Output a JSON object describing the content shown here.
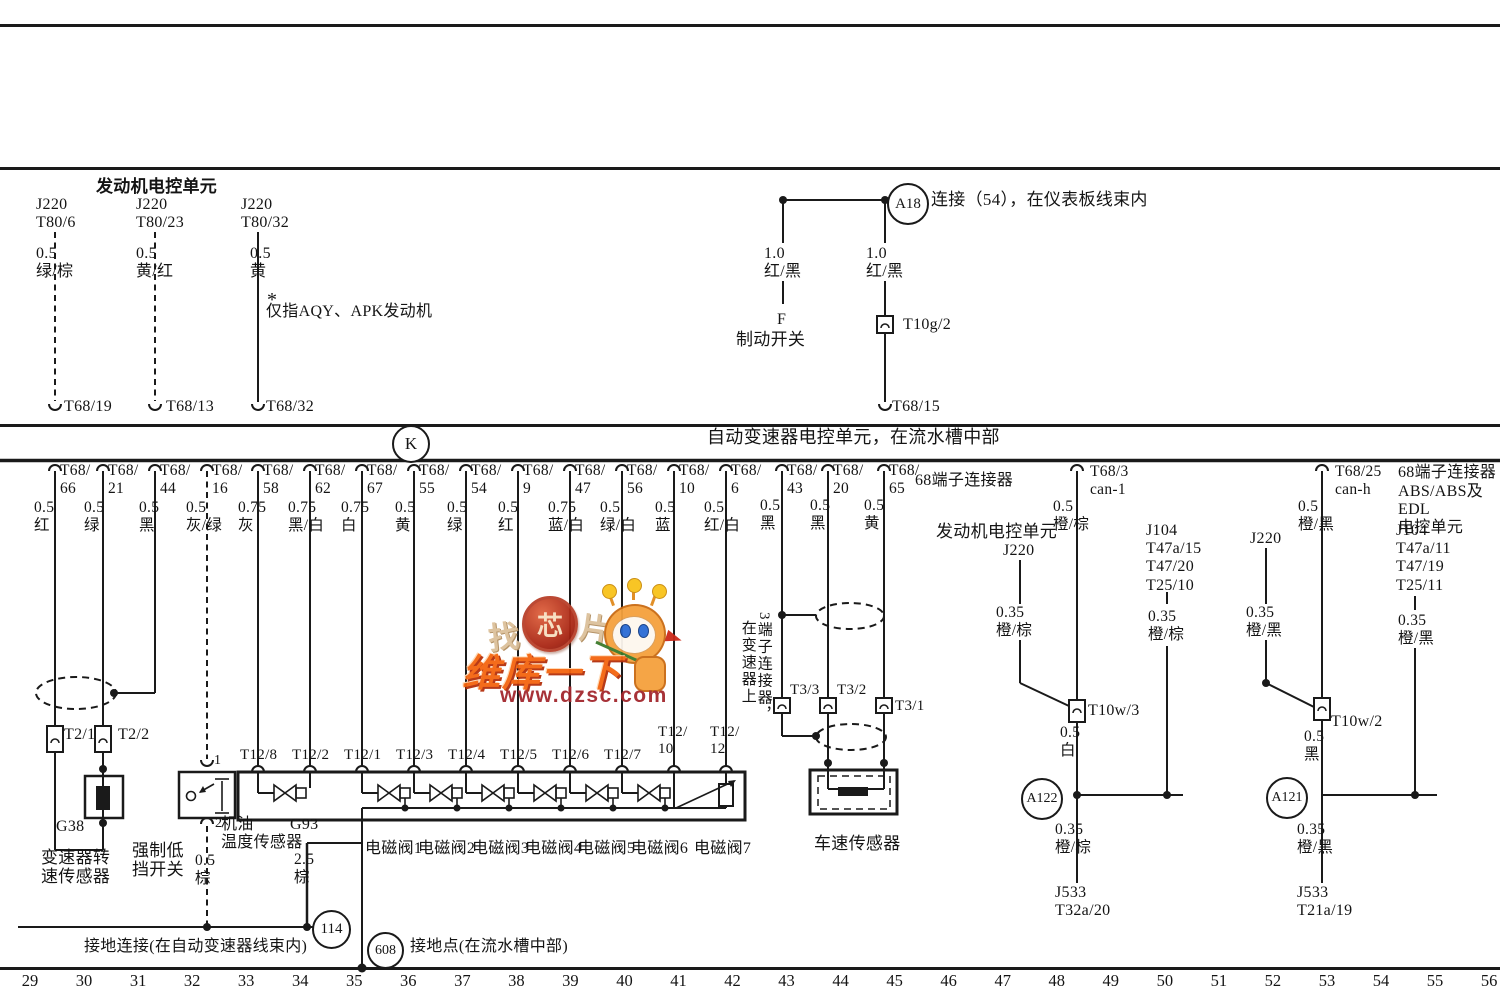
{
  "watermark": {
    "find_1": "找",
    "find_2": "芯",
    "find_3": "片",
    "brand": "维库一下",
    "url": "www.dzsc.com"
  },
  "labels": [
    {
      "n": "engine-ecu-title",
      "t": "发动机电控单元",
      "x": 96,
      "y": 177,
      "fs": 17,
      "b": 1
    },
    {
      "n": "pin-label",
      "t": "J220\nT80/6",
      "x": 36,
      "y": 196,
      "fs": 16
    },
    {
      "n": "pin-label",
      "t": "J220\nT80/23",
      "x": 136,
      "y": 196,
      "fs": 16
    },
    {
      "n": "pin-label",
      "t": "J220\nT80/32",
      "x": 241,
      "y": 196,
      "fs": 16
    },
    {
      "n": "wire-color-label",
      "t": "0.5\n绿/棕",
      "x": 36,
      "y": 245,
      "fs": 16
    },
    {
      "n": "wire-color-label",
      "t": "0.5\n黄/红",
      "x": 136,
      "y": 245,
      "fs": 16
    },
    {
      "n": "wire-color-label",
      "t": "0.5\n黄",
      "x": 250,
      "y": 245,
      "fs": 16
    },
    {
      "n": "footnote-star",
      "t": "*",
      "x": 267,
      "y": 289,
      "fs": 20
    },
    {
      "n": "engine-note",
      "t": "仅指AQY、APK发动机",
      "x": 266,
      "y": 303,
      "fs": 16
    },
    {
      "n": "terminal-label",
      "t": "T68/19",
      "x": 64,
      "y": 398,
      "fs": 16
    },
    {
      "n": "terminal-label",
      "t": "T68/13",
      "x": 166,
      "y": 398,
      "fs": 16
    },
    {
      "n": "terminal-label",
      "t": "T68/32",
      "x": 266,
      "y": 398,
      "fs": 16
    },
    {
      "n": "a18-desc",
      "t": "连接（54），在仪表板线束内",
      "x": 931,
      "y": 190,
      "fs": 17
    },
    {
      "n": "wire-color-label",
      "t": "1.0\n红/黑",
      "x": 764,
      "y": 245,
      "fs": 16
    },
    {
      "n": "brake-switch-id",
      "t": "F",
      "x": 777,
      "y": 311,
      "fs": 16
    },
    {
      "n": "brake-switch-label",
      "t": "制动开关",
      "x": 736,
      "y": 330,
      "fs": 17
    },
    {
      "n": "wire-color-label",
      "t": "1.0\n红/黑",
      "x": 866,
      "y": 245,
      "fs": 16
    },
    {
      "n": "connector-label",
      "t": "T10g/2",
      "x": 903,
      "y": 316,
      "fs": 16
    },
    {
      "n": "terminal-label",
      "t": "T68/15",
      "x": 892,
      "y": 398,
      "fs": 16
    },
    {
      "n": "band-title",
      "t": "自动变速器电控单元，在流水槽中部",
      "x": 707,
      "y": 427,
      "fs": 18
    },
    {
      "n": "pin-label",
      "t": "T68/\n66",
      "x": 60,
      "y": 462
    },
    {
      "n": "wire-color-label",
      "t": "0.5\n红",
      "x": 34,
      "y": 499
    },
    {
      "n": "pin-label",
      "t": "T68/\n21",
      "x": 108,
      "y": 462
    },
    {
      "n": "wire-color-label",
      "t": "0.5\n绿",
      "x": 84,
      "y": 499
    },
    {
      "n": "pin-label",
      "t": "T68/\n44",
      "x": 160,
      "y": 462
    },
    {
      "n": "wire-color-label",
      "t": "0.5\n黑",
      "x": 139,
      "y": 499
    },
    {
      "n": "pin-label",
      "t": "T68/\n16",
      "x": 212,
      "y": 462
    },
    {
      "n": "wire-color-label",
      "t": "0.5\n灰/绿",
      "x": 186,
      "y": 499
    },
    {
      "n": "pin-label",
      "t": "T68/\n58",
      "x": 263,
      "y": 462
    },
    {
      "n": "wire-color-label",
      "t": "0.75\n灰",
      "x": 238,
      "y": 499
    },
    {
      "n": "pin-label",
      "t": "T68/\n62",
      "x": 315,
      "y": 462
    },
    {
      "n": "wire-color-label",
      "t": "0.75\n黑/白",
      "x": 288,
      "y": 499
    },
    {
      "n": "pin-label",
      "t": "T68/\n67",
      "x": 367,
      "y": 462
    },
    {
      "n": "wire-color-label",
      "t": "0.75\n白",
      "x": 341,
      "y": 499
    },
    {
      "n": "pin-label",
      "t": "T68/\n55",
      "x": 419,
      "y": 462
    },
    {
      "n": "wire-color-label",
      "t": "0.5\n黄",
      "x": 395,
      "y": 499
    },
    {
      "n": "pin-label",
      "t": "T68/\n54",
      "x": 471,
      "y": 462
    },
    {
      "n": "wire-color-label",
      "t": "0.5\n绿",
      "x": 447,
      "y": 499
    },
    {
      "n": "pin-label",
      "t": "T68/\n9",
      "x": 523,
      "y": 462
    },
    {
      "n": "wire-color-label",
      "t": "0.5\n红",
      "x": 498,
      "y": 499
    },
    {
      "n": "pin-label",
      "t": "T68/\n47",
      "x": 575,
      "y": 462
    },
    {
      "n": "wire-color-label",
      "t": "0.75\n蓝/白",
      "x": 548,
      "y": 499
    },
    {
      "n": "pin-label",
      "t": "T68/\n56",
      "x": 627,
      "y": 462
    },
    {
      "n": "wire-color-label",
      "t": "0.5\n绿/白",
      "x": 600,
      "y": 499
    },
    {
      "n": "pin-label",
      "t": "T68/\n10",
      "x": 679,
      "y": 462
    },
    {
      "n": "wire-color-label",
      "t": "0.5\n蓝",
      "x": 655,
      "y": 499
    },
    {
      "n": "pin-label",
      "t": "T68/\n6",
      "x": 731,
      "y": 462
    },
    {
      "n": "wire-color-label",
      "t": "0.5\n红/白",
      "x": 704,
      "y": 499
    },
    {
      "n": "pin-label",
      "t": "T68/\n43",
      "x": 787,
      "y": 462
    },
    {
      "n": "wire-color-label",
      "t": "0.5\n黑",
      "x": 760,
      "y": 497
    },
    {
      "n": "pin-label",
      "t": "T68/\n20",
      "x": 833,
      "y": 462
    },
    {
      "n": "wire-color-label",
      "t": "0.5\n黑",
      "x": 810,
      "y": 497
    },
    {
      "n": "pin-label",
      "t": "T68/\n65",
      "x": 889,
      "y": 462
    },
    {
      "n": "wire-color-label",
      "t": "0.5\n黄",
      "x": 864,
      "y": 497
    },
    {
      "n": "connector-note",
      "t": "68端子连接器",
      "x": 915,
      "y": 472,
      "fs": 16
    },
    {
      "n": "pin-label",
      "t": "T68/3\ncan-1",
      "x": 1090,
      "y": 463
    },
    {
      "n": "wire-color-label",
      "t": "0.5\n橙/棕",
      "x": 1053,
      "y": 498
    },
    {
      "n": "pin-label",
      "t": "T68/25\ncan-h",
      "x": 1335,
      "y": 463
    },
    {
      "n": "wire-color-label",
      "t": "0.5\n橙/黑",
      "x": 1298,
      "y": 498
    },
    {
      "n": "connector-note",
      "t": "68端子连接器",
      "x": 1398,
      "y": 464,
      "fs": 16
    },
    {
      "n": "abs-ecu-label",
      "t": "ABS/ABS及EDL\n    电控单元",
      "x": 1398,
      "y": 483,
      "fs": 16
    },
    {
      "n": "engine-ecu-mid",
      "t": "发动机电控单元",
      "x": 936,
      "y": 522,
      "fs": 17
    },
    {
      "n": "pin-label",
      "t": "J220",
      "x": 1003,
      "y": 542,
      "fs": 16
    },
    {
      "n": "pin-label",
      "t": "J104\nT47a/15\nT47/20\nT25/10",
      "x": 1146,
      "y": 522,
      "fs": 16
    },
    {
      "n": "wire-color-label",
      "t": "0.35\n橙/棕",
      "x": 996,
      "y": 604
    },
    {
      "n": "wire-color-label",
      "t": "0.35\n橙/棕",
      "x": 1148,
      "y": 608
    },
    {
      "n": "pin-label",
      "t": "J220",
      "x": 1250,
      "y": 530,
      "fs": 16
    },
    {
      "n": "wire-color-label",
      "t": "0.35\n橙/黑",
      "x": 1246,
      "y": 604
    },
    {
      "n": "pin-label",
      "t": "J104\nT47a/11\nT47/19\nT25/11",
      "x": 1396,
      "y": 522,
      "fs": 16
    },
    {
      "n": "wire-color-label",
      "t": "0.35\n橙/黑",
      "x": 1398,
      "y": 612
    },
    {
      "n": "connector-label",
      "t": "T10w/3",
      "x": 1088,
      "y": 702,
      "fs": 16
    },
    {
      "n": "wire-color-label",
      "t": "0.5\n白",
      "x": 1060,
      "y": 724
    },
    {
      "n": "wire-color-label",
      "t": "0.35\n橙/棕",
      "x": 1055,
      "y": 821
    },
    {
      "n": "pin-label",
      "t": "J533\nT32a/20",
      "x": 1055,
      "y": 884,
      "fs": 16
    },
    {
      "n": "connector-label",
      "t": "T10w/2",
      "x": 1331,
      "y": 713,
      "fs": 16
    },
    {
      "n": "wire-color-label",
      "t": "0.5\n黑",
      "x": 1304,
      "y": 728
    },
    {
      "n": "wire-color-label",
      "t": "0.35\n橙/黑",
      "x": 1297,
      "y": 821
    },
    {
      "n": "pin-label",
      "t": "J533\nT21a/19",
      "x": 1297,
      "y": 884,
      "fs": 16
    },
    {
      "n": "connector-label",
      "t": "T2/1",
      "x": 64,
      "y": 726,
      "fs": 16
    },
    {
      "n": "connector-label",
      "t": "T2/2",
      "x": 118,
      "y": 726,
      "fs": 16
    },
    {
      "n": "component-id",
      "t": "G38",
      "x": 56,
      "y": 818,
      "fs": 16
    },
    {
      "n": "component-label",
      "t": "变速器转\n速传感器",
      "x": 41,
      "y": 848,
      "fs": 17
    },
    {
      "n": "component-label",
      "t": "强制低\n挡开关",
      "x": 132,
      "y": 841,
      "fs": 17
    },
    {
      "n": "pin-number",
      "t": "1",
      "x": 214,
      "y": 753,
      "fs": 14
    },
    {
      "n": "pin-number",
      "t": "2",
      "x": 215,
      "y": 816,
      "fs": 14
    },
    {
      "n": "wire-color-label",
      "t": "0.5\n棕",
      "x": 195,
      "y": 852
    },
    {
      "n": "component-label",
      "t": "机油\n温度传感器",
      "x": 221,
      "y": 816,
      "fs": 16
    },
    {
      "n": "component-id",
      "t": "G93",
      "x": 290,
      "y": 816,
      "fs": 16
    },
    {
      "n": "wire-color-label",
      "t": "2.5\n棕",
      "x": 294,
      "y": 851
    },
    {
      "n": "connector-label",
      "t": "T12/8",
      "x": 240,
      "y": 747,
      "fs": 15
    },
    {
      "n": "connector-label",
      "t": "T12/2",
      "x": 292,
      "y": 747,
      "fs": 15
    },
    {
      "n": "connector-label",
      "t": "T12/1",
      "x": 344,
      "y": 747,
      "fs": 15
    },
    {
      "n": "connector-label",
      "t": "T12/3",
      "x": 396,
      "y": 747,
      "fs": 15
    },
    {
      "n": "connector-label",
      "t": "T12/4",
      "x": 448,
      "y": 747,
      "fs": 15
    },
    {
      "n": "connector-label",
      "t": "T12/5",
      "x": 500,
      "y": 747,
      "fs": 15
    },
    {
      "n": "connector-label",
      "t": "T12/6",
      "x": 552,
      "y": 747,
      "fs": 15
    },
    {
      "n": "connector-label",
      "t": "T12/7",
      "x": 604,
      "y": 747,
      "fs": 15
    },
    {
      "n": "connector-label",
      "t": "T12/\n10",
      "x": 658,
      "y": 724,
      "fs": 15
    },
    {
      "n": "connector-label",
      "t": "T12/\n12",
      "x": 710,
      "y": 724,
      "fs": 15
    },
    {
      "n": "component-label",
      "t": "电磁阀1",
      "x": 365,
      "y": 840,
      "fs": 16
    },
    {
      "n": "component-label",
      "t": "电磁阀2",
      "x": 418,
      "y": 840,
      "fs": 16
    },
    {
      "n": "component-label",
      "t": "电磁阀3",
      "x": 472,
      "y": 840,
      "fs": 16
    },
    {
      "n": "component-label",
      "t": "电磁阀4",
      "x": 525,
      "y": 840,
      "fs": 16
    },
    {
      "n": "component-label",
      "t": "电磁阀5",
      "x": 578,
      "y": 840,
      "fs": 16
    },
    {
      "n": "component-label",
      "t": "电磁阀6",
      "x": 631,
      "y": 840,
      "fs": 16
    },
    {
      "n": "component-label",
      "t": "电磁阀7",
      "x": 694,
      "y": 840,
      "fs": 16
    },
    {
      "n": "connector-label",
      "t": "T3/3",
      "x": 790,
      "y": 682,
      "fs": 15
    },
    {
      "n": "connector-label",
      "t": "T3/2",
      "x": 837,
      "y": 682,
      "fs": 15
    },
    {
      "n": "connector-label",
      "t": "T3/1",
      "x": 895,
      "y": 698,
      "fs": 15
    },
    {
      "n": "vertical-note",
      "t": "在变速器上",
      "x": 739,
      "y": 620,
      "fs": 15,
      "v": 1
    },
    {
      "n": "vertical-note",
      "t": "3端子连接器，",
      "x": 755,
      "y": 612,
      "fs": 15,
      "v": 1
    },
    {
      "n": "component-label",
      "t": "车速传感器",
      "x": 814,
      "y": 834,
      "fs": 17
    },
    {
      "n": "ground-label",
      "t": "接地连接(在自动变速器线束内)",
      "x": 84,
      "y": 938,
      "fs": 16
    },
    {
      "n": "ground-label",
      "t": "接地点(在流水槽中部)",
      "x": 410,
      "y": 938,
      "fs": 16
    }
  ],
  "circles": [
    {
      "n": "a18-node",
      "t": "A18",
      "x": 887,
      "y": 183,
      "d": 38
    },
    {
      "n": "k-symbol",
      "t": "K",
      "x": 392,
      "y": 425,
      "d": 34,
      "fs": 17
    },
    {
      "n": "a122-node",
      "t": "A122",
      "x": 1021,
      "y": 778,
      "d": 38,
      "fs": 14
    },
    {
      "n": "a121-node",
      "t": "A121",
      "x": 1266,
      "y": 777,
      "d": 38,
      "fs": 14
    },
    {
      "n": "ground-114",
      "t": "114",
      "x": 312,
      "y": 910,
      "d": 35
    },
    {
      "n": "ground-608",
      "t": "608",
      "x": 367,
      "y": 932,
      "d": 33,
      "fs": 14
    }
  ],
  "ruler": {
    "y": 971,
    "x_start": 10,
    "step": 54.04,
    "width": 40,
    "values": [
      "29",
      "30",
      "31",
      "32",
      "33",
      "34",
      "35",
      "36",
      "37",
      "38",
      "39",
      "40",
      "41",
      "42",
      "43",
      "44",
      "45",
      "46",
      "47",
      "48",
      "49",
      "50",
      "51",
      "52",
      "53",
      "54",
      "55",
      "56"
    ]
  }
}
